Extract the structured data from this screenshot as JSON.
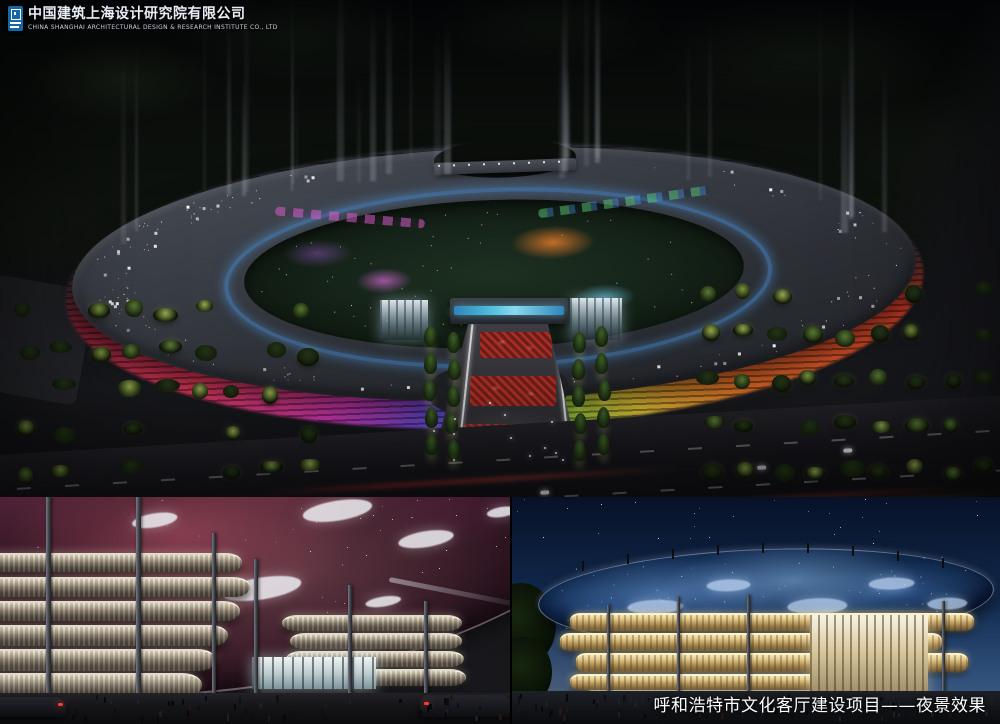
{
  "header": {
    "company_name_cn": "中国建筑上海设计研究院有限公司",
    "company_name_en": "CHINA SHANGHAI ARCHITECTURAL DESIGN & RESEARCH INSTITUTE CO., LTD"
  },
  "footer": {
    "caption": "呼和浩特市文化客厅建设项目——夜景效果"
  },
  "palette": {
    "logo_blue": "#1767a8",
    "caption_color": "#ffffff",
    "led_pink": "#d83ab8",
    "led_purple": "#7a4ad8",
    "led_blue": "#4a66d8",
    "led_green": "#3fae4c",
    "led_yellow": "#e8c83a",
    "led_orange": "#e06a28",
    "led_red": "#cc3a2a"
  }
}
